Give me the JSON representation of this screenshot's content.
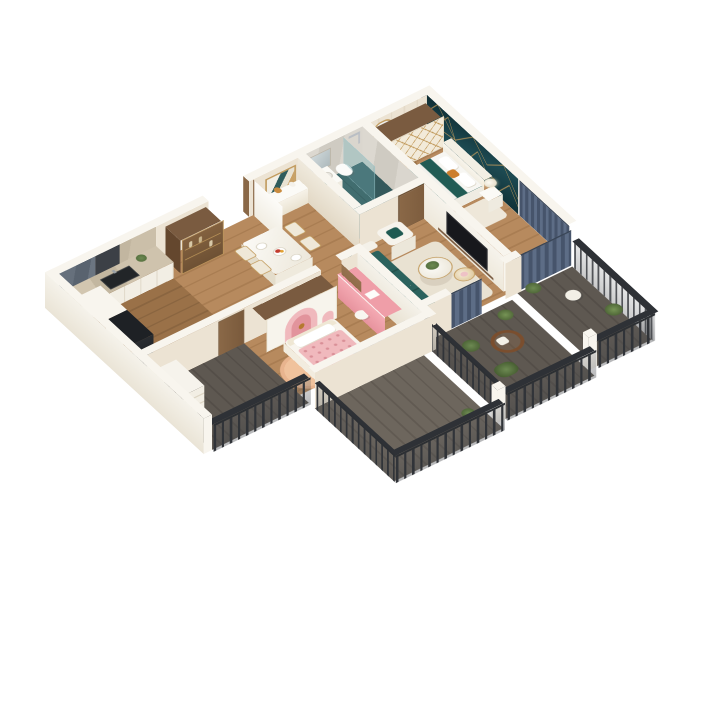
{
  "window": {
    "background": "#ffffff",
    "type": "3d-apartment-floor-plan-render"
  },
  "logo": {
    "mark": "EZ",
    "tagline": "▪▪▪▪▪ ▪▪▪▪▪▪"
  },
  "palette": {
    "bg": "#ffffff",
    "wall": "#ece3d3",
    "wallBright": "#f5f2ea",
    "cap": "#f8f5ee",
    "wood": "#b78a5e",
    "woodDark": "#a97d52",
    "kitchenFloor": "#9a7148",
    "balconyFloor": "#5e5851",
    "balconyFloor2": "#6d665d",
    "accentTeal": "#0e2b31",
    "accentTeal2": "#225159",
    "gold": "#c19a5c",
    "tealSofa": "#2b625d",
    "tealSofaDark": "#234f4b",
    "tealBed": "#215c55",
    "pink": "#f0b9bd",
    "pinkDeep": "#e2949c",
    "pinkDesk": "#ef9ea8",
    "peach": "#f0c29c",
    "navy": "#46546b",
    "grayCurtain": "#aab0b8",
    "railDark": "#33363b",
    "marbleBeige": "#c9bda7",
    "marbleGray": "#5d6874",
    "marbleLight": "#d6d2c9",
    "bathFloor": "#416d6f",
    "bathFloorDark": "#35595c",
    "mustard": "#c98b3f",
    "orange": "#cc7f2e",
    "white": "#fafaf8",
    "tvBlack": "#17181c",
    "wood2": "#7a5b40",
    "doorWood": "#8a6847",
    "green": "#5d7a45",
    "rattan": "#7a4e2e",
    "fridge": "#1e2125"
  },
  "scene": {
    "rooms": [
      {
        "name": "kitchen",
        "items": [
          "marble-backsplash",
          "counter-with-sink",
          "fridge",
          "tall-cabinet",
          "plant"
        ]
      },
      {
        "name": "dining-hall",
        "items": [
          "entry-door",
          "display-cabinet",
          "dining-table",
          "four-chairs",
          "artwork",
          "console-vases"
        ]
      },
      {
        "name": "bathroom",
        "items": [
          "vanity-mirror",
          "toilet",
          "glass-shower",
          "teal-tile-floor",
          "wood-door"
        ]
      },
      {
        "name": "master-bedroom",
        "items": [
          "teal-gold-accent-wall",
          "wardrobe-gold-trim",
          "bed-teal-bedding",
          "bedside-lamp",
          "mustard-pouf",
          "dressing-mirror",
          "navy-curtains",
          "clothes-rack",
          "plant"
        ]
      },
      {
        "name": "living-room",
        "items": [
          "teal-sofa",
          "white-armchair",
          "round-coffee-tables",
          "tv-media-wall",
          "cream-rug"
        ]
      },
      {
        "name": "kids-room",
        "items": [
          "pink-arch-wardrobe",
          "pink-bed",
          "pink-desk",
          "peach-rug",
          "gray-curtains",
          "wood-door"
        ]
      },
      {
        "name": "balconies",
        "items": [
          "metal-railings",
          "rattan-chair",
          "plants",
          "service-shelf"
        ]
      }
    ]
  }
}
